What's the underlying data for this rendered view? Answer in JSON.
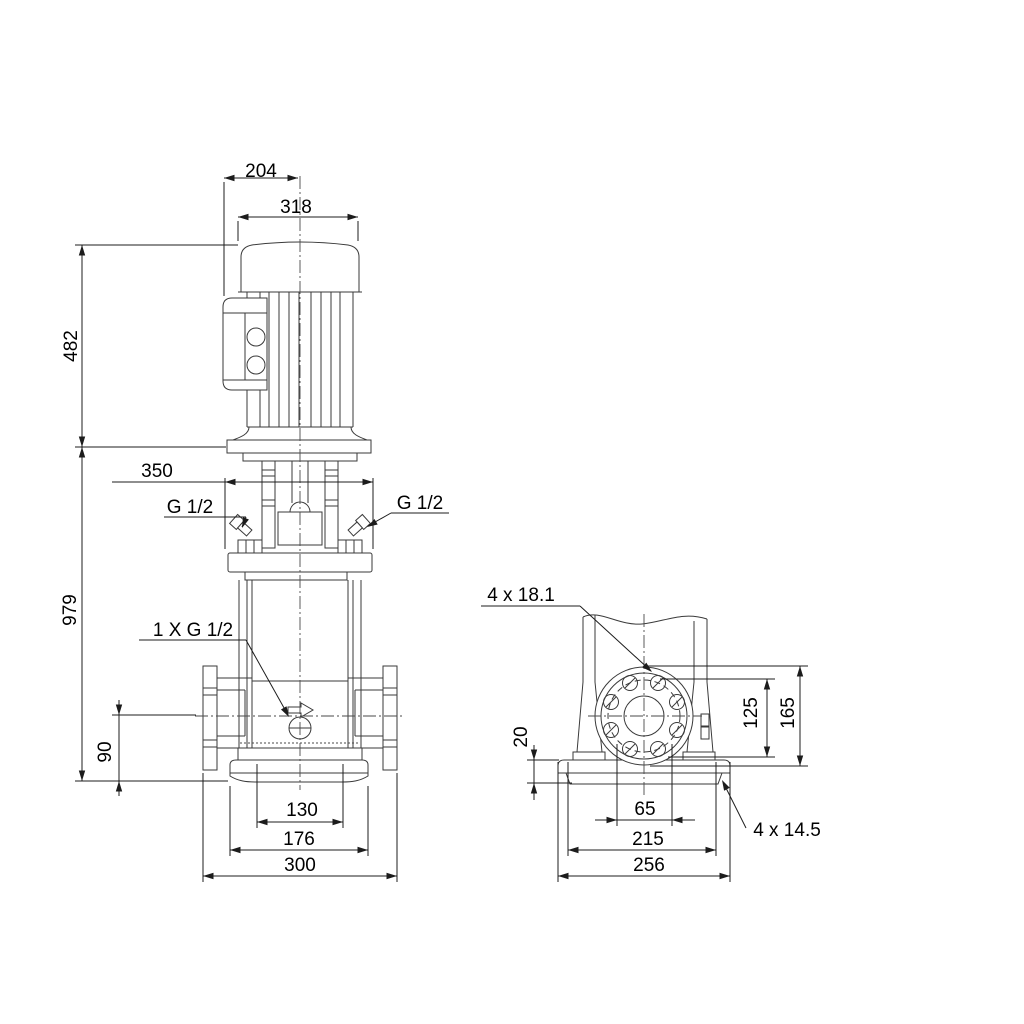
{
  "drawing": {
    "kind": "technical dimensional drawing",
    "colors": {
      "line": "#3a3a3a",
      "dimension": "#1c1c1c",
      "background": "#ffffff"
    }
  },
  "dimensions": {
    "front_view": {
      "motor_top_width": "204",
      "motor_width": "318",
      "motor_height": "482",
      "pump_head_width": "350",
      "gauge_port_left": "G 1/2",
      "gauge_port_right": "G 1/2",
      "total_height": "979",
      "drain_port": "1 X G 1/2",
      "drain_height": "90",
      "base_inner_width": "130",
      "base_width": "176",
      "port_to_port": "300"
    },
    "side_view": {
      "flange_holes": "4 x 18.1",
      "flange_bolt_circle_height": "125",
      "flange_outer_height": "165",
      "base_plate_thickness": "20",
      "base_slot_spacing": "65",
      "base_bolt_spacing": "215",
      "base_depth": "256",
      "base_holes": "4 x 14.5"
    }
  }
}
